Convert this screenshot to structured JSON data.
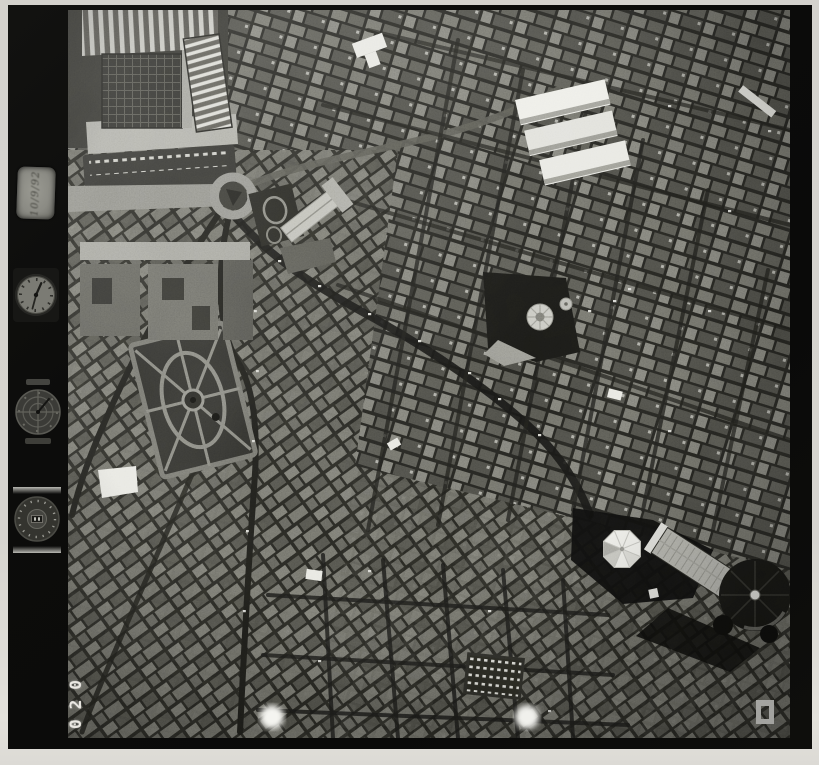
{
  "sheet": {
    "kind": "scanned monochrome vertical aerial photograph on film",
    "page_background": "#d5d3ce",
    "film_color": "#0c0c0b"
  },
  "film": {
    "frame_number": "020",
    "data_plate_text": "10/9/92",
    "instruments": [
      {
        "name": "data-plate",
        "glyph": "handwritten date plate"
      },
      {
        "name": "clock-dial",
        "glyph": "mission clock face with hands"
      },
      {
        "name": "altimeter-dial",
        "glyph": "altimeter with cross reticle"
      },
      {
        "name": "counter-dial",
        "glyph": "frame counter dial with digit window"
      }
    ],
    "fiducial_marks": 2
  },
  "photo": {
    "content": "dense historic city centre seen from directly above",
    "landmarks": [
      "railway-station-complex",
      "station-platform-canopies",
      "station-parking-lot",
      "station-roundabout",
      "gabled-church-roof",
      "market-hall-roofs",
      "domed-basilica",
      "formal-garden-parterre",
      "large-courtyard-complex",
      "octagonal-white-dome",
      "cathedral-nave-roof",
      "cathedral-dome",
      "market-stalls"
    ],
    "tones": {
      "deep_shadow": "#0e0e0c",
      "street": "#1b1b18",
      "roof_mid": "#62625c",
      "roof_light": "#9c9c94",
      "highlight": "#f1f1ec"
    }
  }
}
